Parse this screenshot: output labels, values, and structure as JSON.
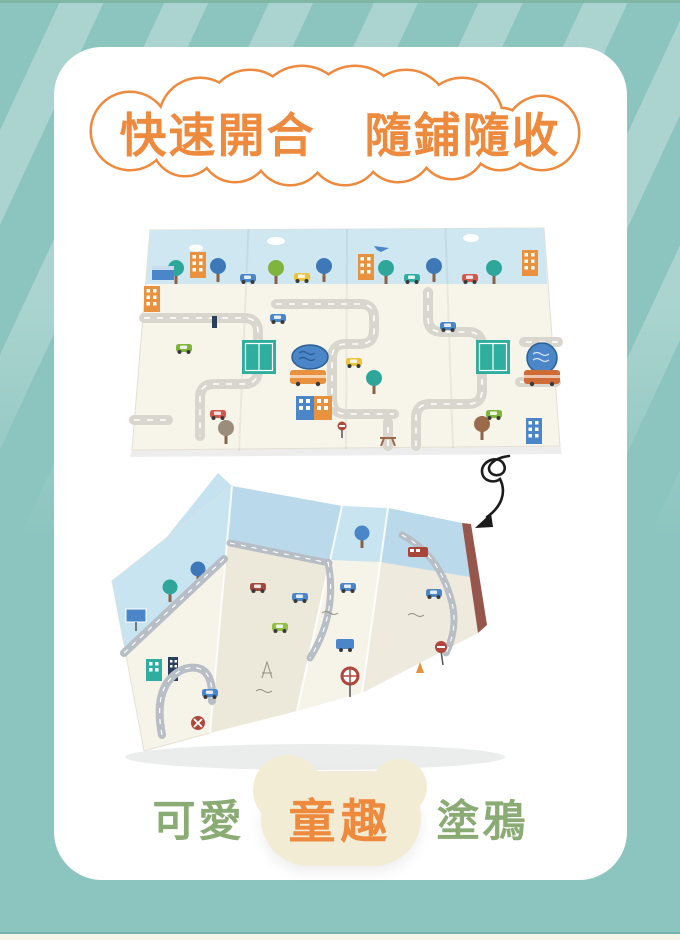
{
  "banner": {
    "text": "快速開合　隨鋪隨收"
  },
  "caption": {
    "prefix": "可愛",
    "highlight": "童趣",
    "suffix": "塗鴉"
  },
  "illustrations": {
    "unfolded_mat": "city-road-baby-play-mat-unfolded",
    "folded_mat": "city-road-baby-play-mat-accordion-folded",
    "arrow_icon": "curly-doodle-arrow-down"
  },
  "colors": {
    "background_teal": "#8cc5bf",
    "stripe_light": "#aedad4",
    "card_white": "#ffffff",
    "accent_orange": "#ee8a3d",
    "accent_green": "#8aab74",
    "bubble_cream": "#f3ecd5",
    "mat_sky_blue": "#cfe7f1",
    "mat_cream": "#f7f5ea",
    "road_gray": "#d8d6cd",
    "folded_road_gray": "#b8bec6"
  }
}
